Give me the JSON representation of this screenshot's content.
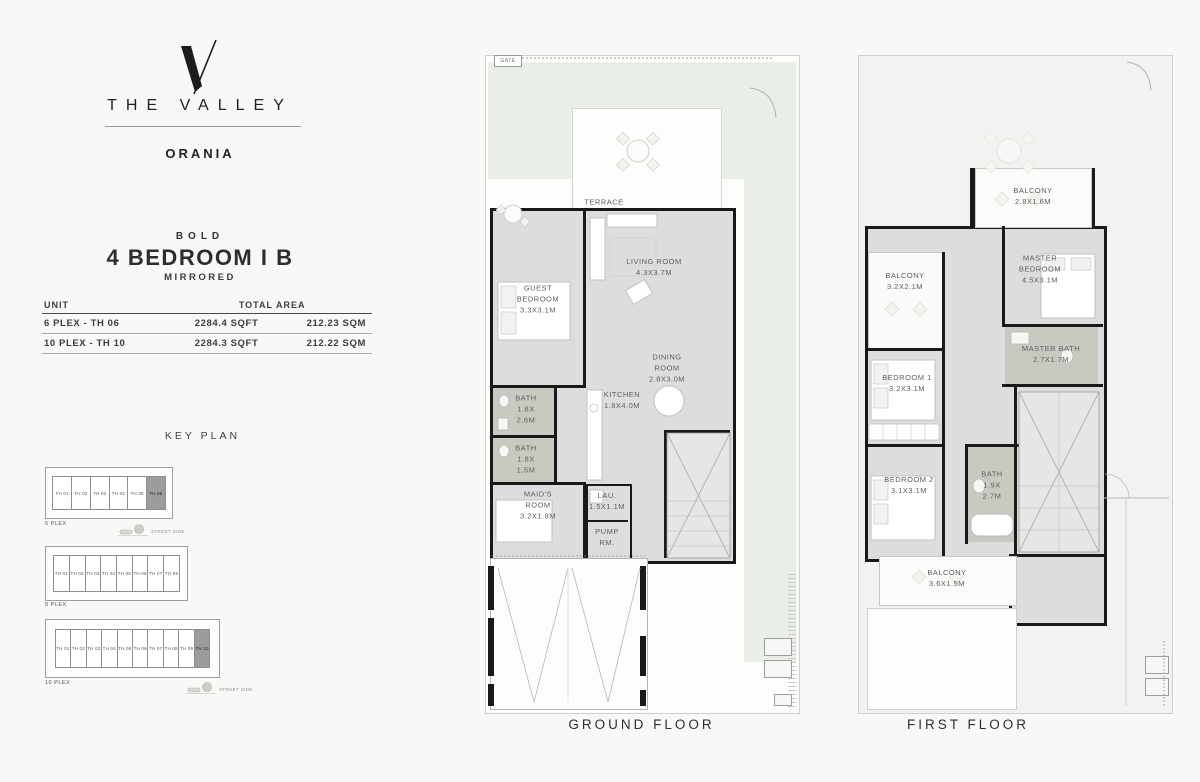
{
  "brand": {
    "logo_mark": "V",
    "name": "THE VALLEY",
    "community": "ORANIA"
  },
  "unit_header": {
    "collection": "BOLD",
    "title": "4 BEDROOM I B",
    "variant": "MIRRORED"
  },
  "area_table": {
    "headers": {
      "unit": "UNIT",
      "total_area": "TOTAL AREA"
    },
    "rows": [
      {
        "unit": "6 PLEX - TH 06",
        "sqft": "2284.4 SQFT",
        "sqm": "212.23 SQM"
      },
      {
        "unit": "10 PLEX - TH 10",
        "sqft": "2284.3 SQFT",
        "sqm": "212.22 SQM"
      }
    ]
  },
  "key_plan": {
    "title": "KEY PLAN",
    "street_label": "STREET SIDE",
    "blocks": [
      {
        "label": "6 PLEX",
        "highlight_index": 5,
        "units": [
          "TH 01",
          "TH 02",
          "TH 03",
          "TH 04",
          "TH 05",
          "TH 06"
        ]
      },
      {
        "label": "8 PLEX",
        "highlight_index": -1,
        "units": [
          "TH 01",
          "TH 02",
          "TH 03",
          "TH 04",
          "TH 05",
          "TH 06",
          "TH 07",
          "TH 08"
        ]
      },
      {
        "label": "10 PLEX",
        "highlight_index": 9,
        "units": [
          "TH 01",
          "TH 02",
          "TH 03",
          "TH 04",
          "TH 05",
          "TH 06",
          "TH 07",
          "TH 08",
          "TH 09",
          "TH 10"
        ]
      }
    ]
  },
  "ground_floor": {
    "caption": "GROUND FLOOR",
    "gate_label": "GATE",
    "rooms": {
      "terrace": {
        "name": "TERRACE",
        "dims": ""
      },
      "living": {
        "name": "LIVING ROOM",
        "dims": "4.3X3.7M"
      },
      "guest": {
        "name": "GUEST BEDROOM",
        "dims": "3.3X3.1M"
      },
      "dining": {
        "name": "DINING ROOM",
        "dims": "2.8X3.0M"
      },
      "kitchen": {
        "name": "KITCHEN",
        "dims": "1.8X4.0M"
      },
      "bath1": {
        "name": "BATH",
        "dims": "1.8X 2.6M"
      },
      "bath2": {
        "name": "BATH",
        "dims": "1.8X 1.5M"
      },
      "maid": {
        "name": "MAID'S ROOM",
        "dims": "3.2X1.8M"
      },
      "laundry": {
        "name": "LAU.",
        "dims": "1.5X1.1M"
      },
      "pump": {
        "name": "PUMP RM.",
        "dims": ""
      }
    }
  },
  "first_floor": {
    "caption": "FIRST FLOOR",
    "rooms": {
      "balcony_top": {
        "name": "BALCONY",
        "dims": "2.8X1.6M"
      },
      "master": {
        "name": "MASTER BEDROOM",
        "dims": "4.5X3.1M"
      },
      "balcony_left": {
        "name": "BALCONY",
        "dims": "3.2X2.1M"
      },
      "bedroom1": {
        "name": "BEDROOM 1",
        "dims": "3.2X3.1M"
      },
      "master_bath": {
        "name": "MASTER BATH",
        "dims": "2.7X1.7M"
      },
      "bedroom2": {
        "name": "BEDROOM 2",
        "dims": "3.1X3.1M"
      },
      "bath": {
        "name": "BATH",
        "dims": "1.9X 2.7M"
      },
      "balcony_bottom": {
        "name": "BALCONY",
        "dims": "3.6X1.5M"
      }
    }
  },
  "colors": {
    "page_bg": "#f9f8f6",
    "lawn": "#e9efe6",
    "floor": "#dcdddd",
    "bath_floor": "#c9c9c1",
    "wall": "#191919",
    "keyplan_highlight": "#9c9c9c"
  }
}
